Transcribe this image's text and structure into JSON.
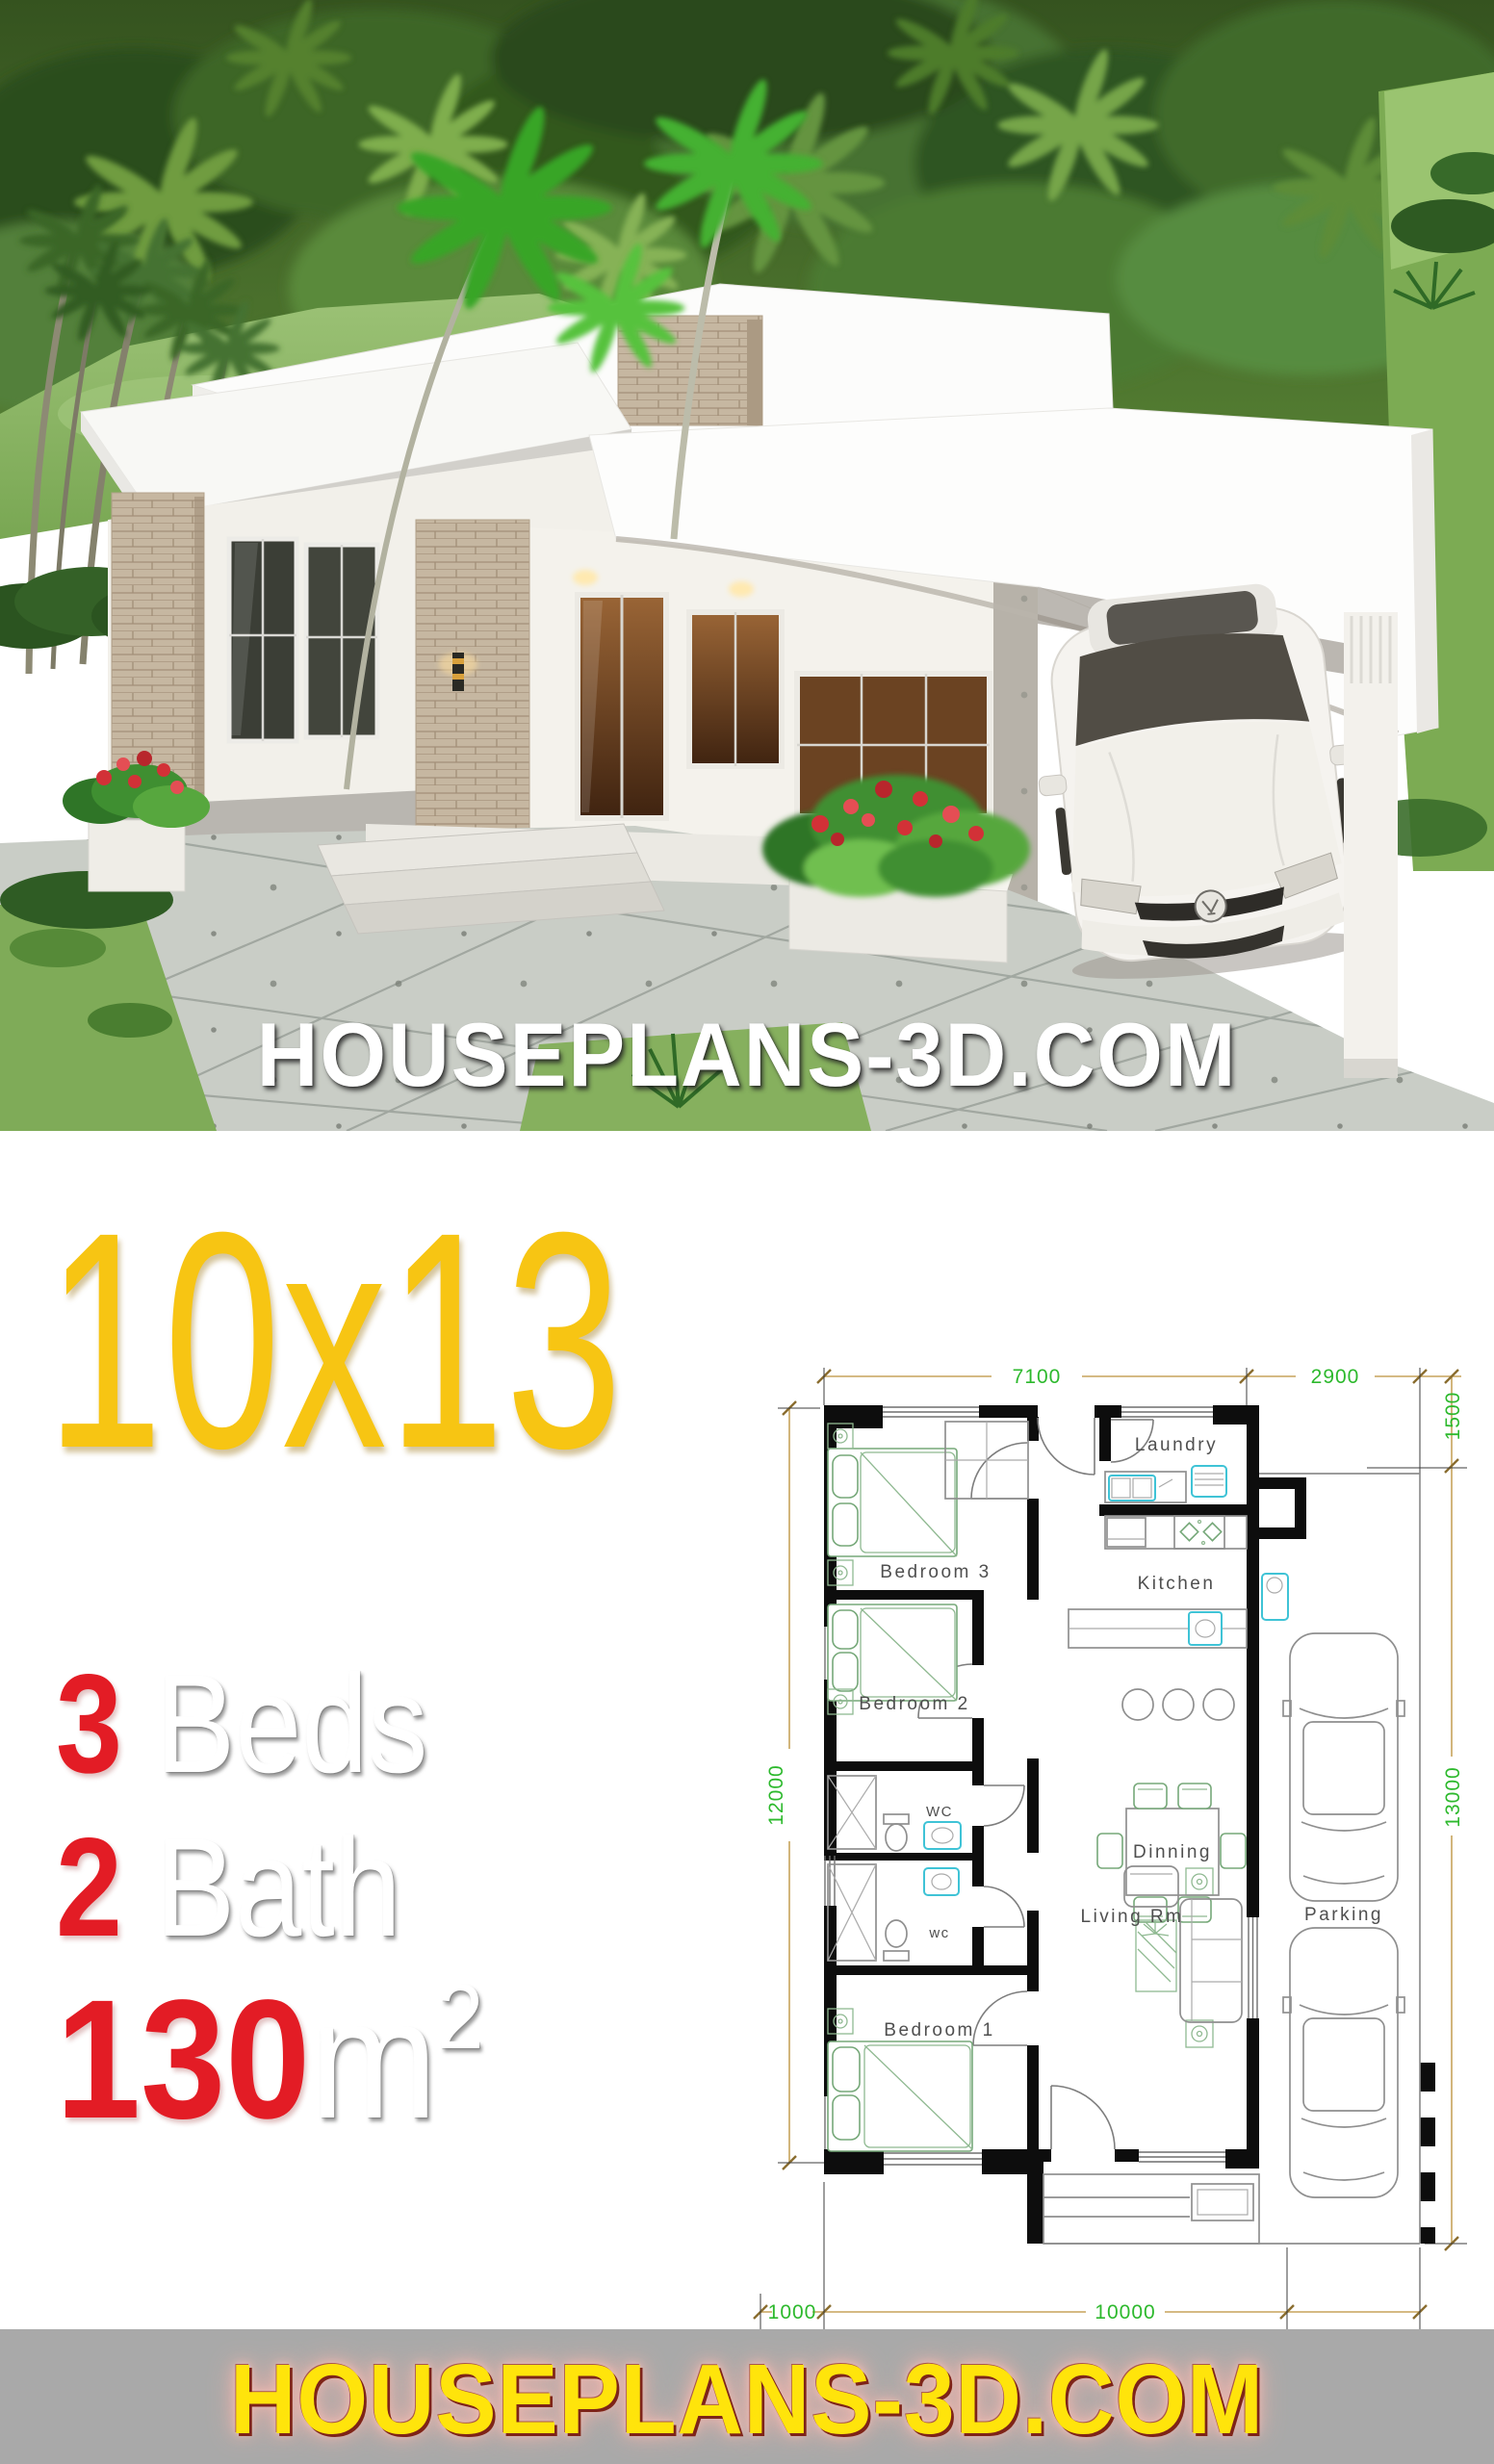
{
  "hero": {
    "watermark": "HOUSEPLANS-3D.COM"
  },
  "title": {
    "text": "10x13"
  },
  "specs": [
    {
      "value": "3",
      "label": "Beds"
    },
    {
      "value": "2",
      "label": "Bath"
    },
    {
      "value": "130",
      "label": "m",
      "superscript": "2"
    }
  ],
  "floor_plan": {
    "dims": {
      "top_main": "7100",
      "top_carport": "2900",
      "offset_right": "1500",
      "left": "12000",
      "right": "13000",
      "bottom_offset": "1000",
      "bottom_main": "10000"
    },
    "rooms": {
      "bedroom3": "Bedroom 3",
      "bedroom2": "Bedroom 2",
      "bedroom1": "Bedroom 1",
      "laundry": "Laundry",
      "kitchen": "Kitchen",
      "dinning": "Dinning",
      "living": "Living Rm",
      "parking": "Parking",
      "wc_upper": "WC",
      "wc_lower": "wc"
    }
  },
  "footer": {
    "site": "HOUSEPLANS-3D.COM"
  },
  "colors": {
    "accent_yellow": "#f7c513",
    "accent_red": "#e31c25",
    "dim_green": "#2db92d",
    "dim_tan": "#c7a45c",
    "fixture_cyan": "#3fc3d6",
    "footer_bg": "#a9a9a9",
    "footer_text": "#ffe40b"
  }
}
